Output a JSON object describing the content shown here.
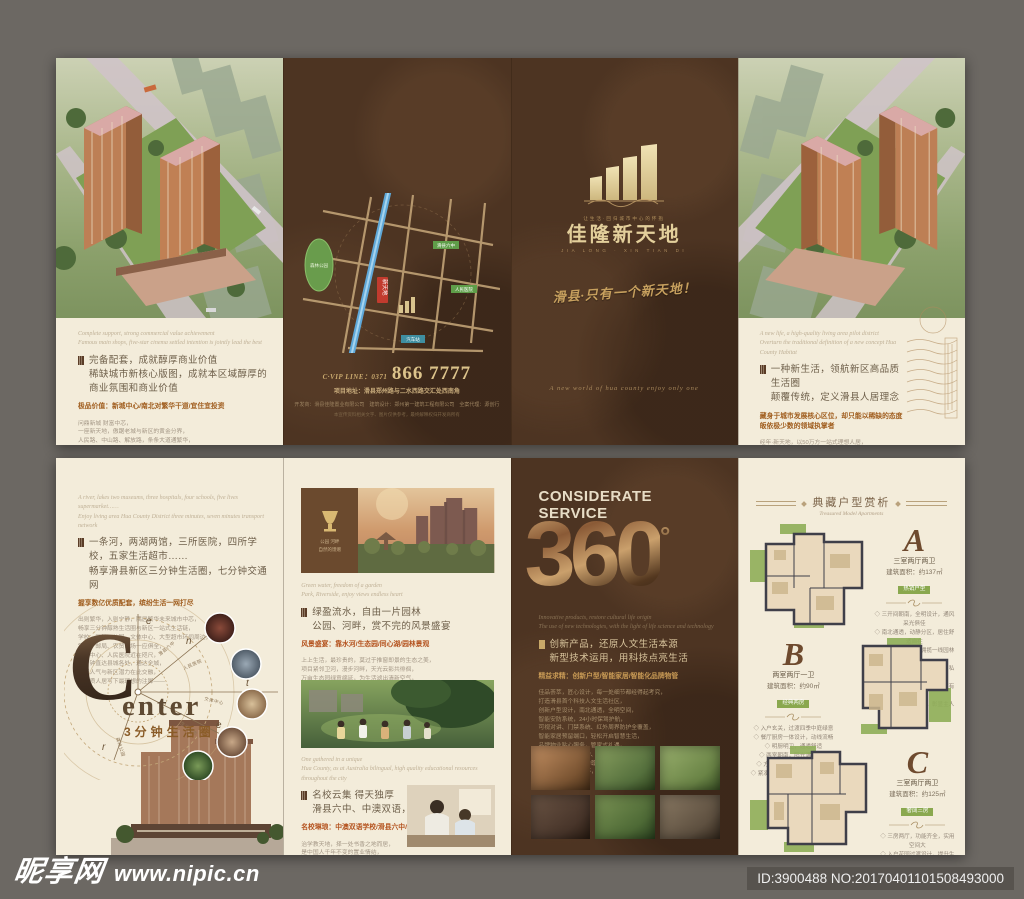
{
  "footer": {
    "site_name": "昵享网",
    "site_url": "www.nipic.cn",
    "image_id": "ID:3900488 NO:20170401101508493000"
  },
  "outer": {
    "commerce": {
      "en": "Complete support, strong commercial value achievement\nFamous main shops, five-star cinema settled intention is jointly lead the best",
      "heading": "完备配套，成就醇厚商业价值\n稀缺城市新核心版图，成就本区域醇厚的商业氛围和商业价值",
      "bold": "极品价值：新城中心/南北对繁华干道/宜住宜投资",
      "body": "问鼎新城 财富中芯，\n一座新天地，傲踞老城与新区的黄金分界，\n人民路、中山路、解放路，条条大道通繁华，\n项目周边，商铺林立、车水马龙，\n升级中的新区版图，正以惊人的速度兑现价值，\n紧邻行政中心、商业中心，醇熟配套一应俱全，\n五星影院、品牌主力店相继进驻，\n于繁华中心，独享一方旺地，\n置业于此，升值看得见，\n这里，将是滑县下一个财富高地——"
    },
    "map_panel": {
      "vip_line": "C·VIP LINE：0371",
      "phone": "866 7777",
      "address": "项目地址：滑县郑州路与二水西路交汇处西南角",
      "credits": "开发商：滑县佳隆置业有限公司　建筑设计：郑州第一建筑工程有限公司　全案代理：源创行",
      "fineprint": "本宣传资料相关文字、图片仅供参考，最终解释权归开发商所有",
      "labels": {
        "park": "森林公园",
        "school": "滑县六中",
        "hospital": "人民医院",
        "station": "汽车站",
        "marker": "新天地"
      }
    },
    "cover": {
      "logo_tagline": "让生活·回归城市中心的怀抱",
      "logo_name": "佳隆新天地",
      "logo_sub": "JIA LONG · XIN TIAN DI",
      "slogan": "滑县·只有一个新天地！",
      "script_en": "A new world of hua county enjoy only one"
    },
    "life": {
      "en": "A new life, a high-quality living area pilot district\nOverturn the traditional definition of a new concept Hua County Habitat",
      "heading": "一种新生活，领航新区高品质生活圈\n颠覆传统，定义滑县人居理念",
      "bold": "藏身于城市发展核心区位，却只能以稀缺的态度皈依极少数的领域执掌者",
      "body": "经年·新天地，以50万方一站式理想人居，\n占位城市中芯，回应一座城市的理想，\n于滑县新老城交汇之芯的高尚地段，\n以醇熟、低密、一站式的精工人居，\n回应这座城市对品质生活的全部期待，\n布局商业、教育、园林完整生活链，\n领衔滑县，重写这座城市的人居高度，\n只为极少数人的理想栖居——"
    }
  },
  "inner": {
    "center": {
      "en": "A river, lakes two museums, three hospitals, four schools, five lives supermarket……\nEnjoy living area Hua County District three minutes, seven minutes transport network",
      "heading": "一条河，两湖两馆，三所医院，四所学校，五家生活超市……\n畅享滑县新区三分钟生活圈，七分钟交通网",
      "bold": "握享数亿优质配套，缤纷生活一网打尽",
      "body": "出则繁华，入则宁静，隅居繁华未来城市中芯，\n畅享三分钟醇熟生活圈与新区一站式生活链，\n学校、医院、公园、文体中心、大型超市环伺周边，\n银行、邮局、农贸市场一应俱全，\n政务中心、人民医院近在咫尺，\n七分钟直达县城各处，通达全城，\n老城人气与新区潜力在此交融，\n为品质人居写下最理想的注脚——",
      "big_letter": "C",
      "word": "enter",
      "sub": "3分钟生活圈",
      "ring_letters": [
        "e",
        "n",
        "t",
        "e",
        "r"
      ],
      "ring_labels": [
        "滑县六中",
        "人民医院",
        "文体中心",
        "生活超市",
        "森林公园"
      ]
    },
    "scenery": {
      "box_caption": "公园 河畔\n自然的馈赠",
      "en": "Green water, freedom of a garden\nPark, Riverside, enjoy views endless heart",
      "heading": "绿盈流水，自由一片园林\n公园、河畔，赏不完的风景盛宴",
      "bold": "风景盛宴：靠水河/生态园/同心湖/园林景观",
      "body": "上上生活，最珍贵的，莫过于推窗即景的生态之美，\n项目紧邻卫河，漫步河畔，天光云影共徘徊，\n万亩生态园绿意绵延，为生活滤出清新空气，\n社区园林景观匠心布局，一步一景，\n绿荫道、亲水平台、中心湖景，尽显自然意趣，\n晨可闻鸟语，暮可赏霞光，\n于喧嚣都市，独享一片诗意栖居——",
      "en2": "One gathered in a unique\nHua County, as at Australia bilingual, high quality educational resources throughout the city",
      "heading2": "名校云集 得天独厚\n滑县六中、中澳双语，15年全程金质教育",
      "bold2": "名校琳琅：中澳双语学校/滑县六中/明德小学——",
      "body2": "治学教天地，择一处书香之地而居，\n是中国人千年不变的置业情结，\n项目周边名校林立，书声琅琅，\n中澳双语学校、明德小学、滑县六中环伺左右，\n孩子在家门口入学，成长赢在起跑线，\n晨送暮接，不再为孩子求学奔波，\n15年全程金质教育，成就书香门第的理想——"
    },
    "service": {
      "title": "CONSIDERATE\nSERVICE",
      "big": "360",
      "degree": "°",
      "en": "Innovative products, restore cultural life origin\nThe use of new technologies, with the light of life science and technology",
      "heading": "创新产品，还原人文生活本源\n新型技术运用，用科技点亮生活",
      "bold": "精益求精：创新户型/智能家居/智能化品牌物管",
      "body": "佳品荟萃，匠心设计，每一处细节都经得起考究，\n打造滑县首个科技人文生活社区，\n创新户型设计，南北通透，全明空间，\n智能安防系统，24小时保驾护航，\n可视对讲、门禁系统、红外周界防护全覆盖，\n智能家居预留端口，轻松开启智慧生活，\n品牌物业贴心服务，管家式礼遇，\n园区保洁、绿化养护、设施维保一丝不苟，\n从细节处还原生活的尊崇感，\n360°全方位人文关怀，只为懂生活的你——"
    },
    "plans": {
      "header": "典藏户型赏析",
      "header_script": "Treasured Model Apartments",
      "items": [
        {
          "letter": "A",
          "name": "三室两厅两卫",
          "area": "建筑面积：约137㎡",
          "badge": "热销户型",
          "bullets": "◇ 三开间朝南，全明设计，通风采光俱佳\n◇ 南北通透，动静分区，居住舒适自在\n◇ 超大观景阳台，拥揽一线园林美景\n◇ 主卧套房设计，独立卫浴，私密尊崇\n◇ 餐客厅一体，聚会宴客从容有度\n◇ 更有入户玄关设计，彰显主人居家品味"
        },
        {
          "letter": "B",
          "name": "两室两厅一卫",
          "area": "建筑面积：约90㎡",
          "badge": "经典两房",
          "bullets": "◇ 入户玄关，过渡四季中庭绿意\n◇ 餐厅厨房一体设计，动线流畅\n◇ 明厨明卫，通透舒适\n◇ 两室朝南，阳光满盈室内\n◇ 方正实用，零浪费空间设计\n◇ 紧凑户型，总价更低，幸福轻松起步"
        },
        {
          "letter": "C",
          "name": "三室两厅两卫",
          "area": "建筑面积：约125㎡",
          "badge": "奢阔三房",
          "bullets": "◇ 三房两厅，功能齐全，实用空间大\n◇ 入户花园过渡设计，提升生活仪式感\n◇ 餐厅客厅通透相连，南向宽景阳台\n◇ 主卧独立卫浴，大尺度豪华享受\n◇ 双阳台赠送设计，延展更多可能\n◇ 南向采光面超宽，尽享阳光馈赠"
        }
      ]
    }
  }
}
